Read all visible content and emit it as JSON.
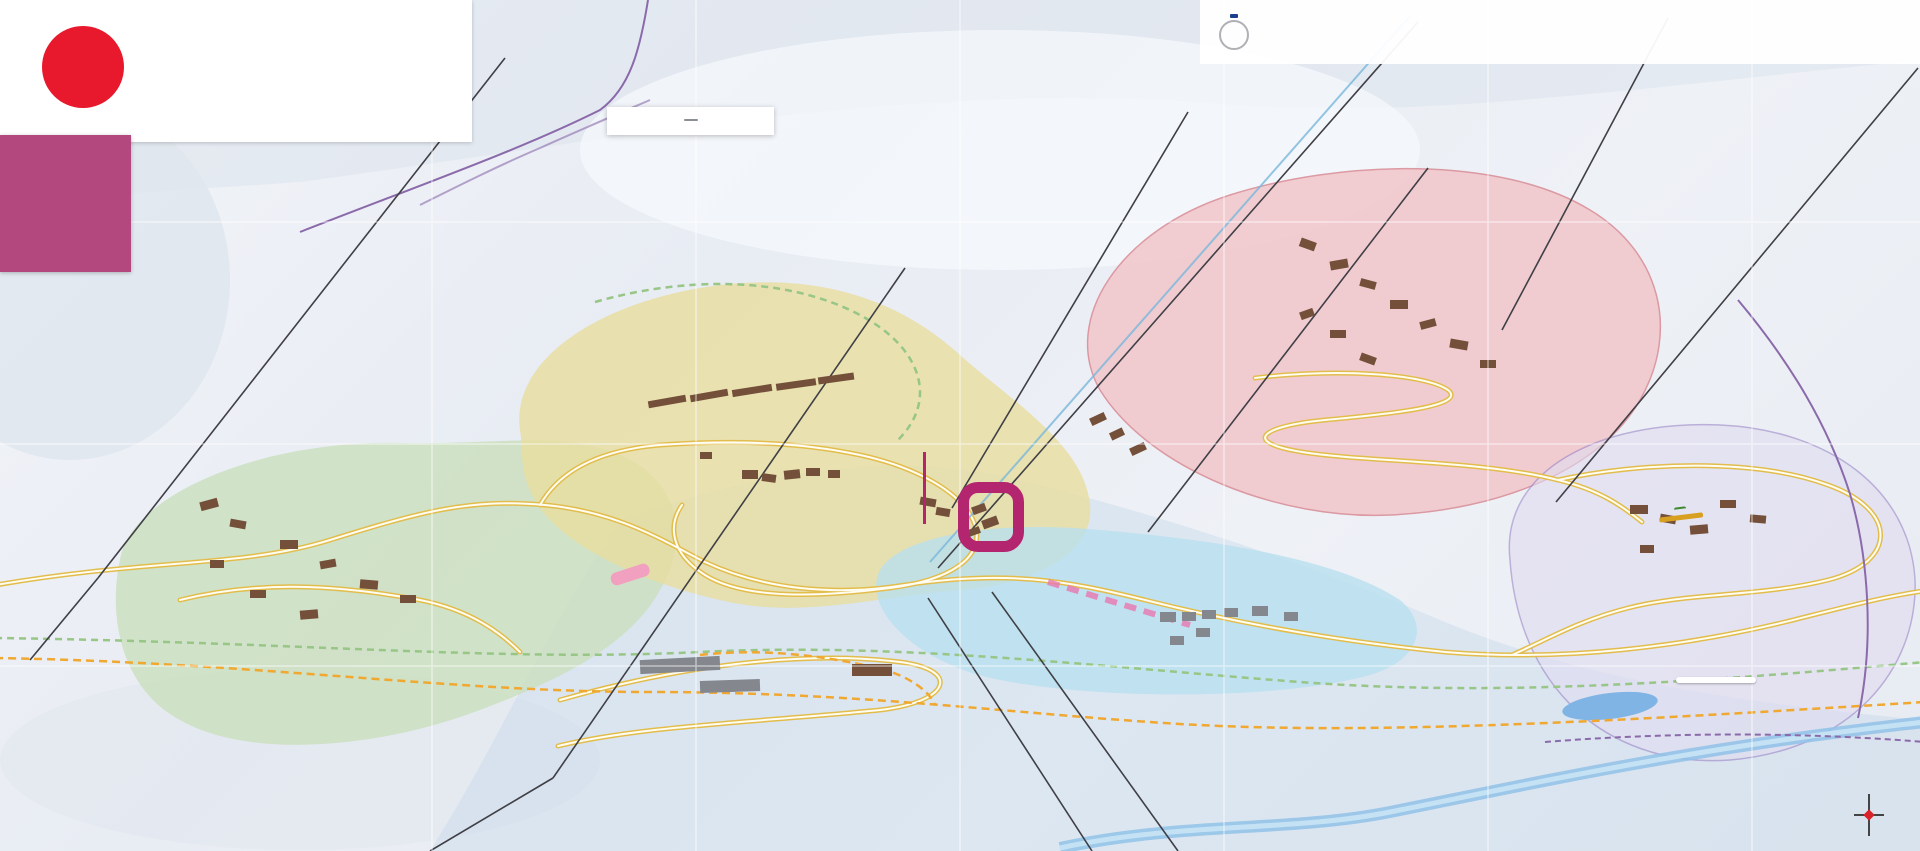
{
  "brand": {
    "logo_letter": "M",
    "name_red": "friendly",
    "name_blue": "Menuires",
    "tagline": "LES 3 VALLÉES"
  },
  "alpes": {
    "flake": "✻",
    "name": "ALPES",
    "subtitle": "IMMOBILIER & SERVICES"
  },
  "tourism": {
    "badge": "OUR QUALITY\nCOMMITMENT",
    "logo_letter": "Q",
    "logo_caption": "QUALITÉ\nTOURISME",
    "text": "L'Office de Tourisme des Menuires Saint-Martin-de-Belleville est engagé dans une démarche qualité reconnue par l'Etat et a obtenu la marque nationale QUALITE TOURISME™ pour une ou plusieurs de ses activités."
  },
  "famille": {
    "logo_blue": "Famille",
    "logo_orange": "Plus",
    "star": "★",
    "logo_sub": "VIVRE ENSEMBLE\nDE BELLES EXPÉRIENCES",
    "text_fr": "Les Menuires, station Famille Plus s'engage pour l'accueil des petits et des grands. ",
    "text_en": "A Famille Plus resort, commits itself to giving a special welcome to young and old alike."
  },
  "legend": {
    "title": "LA CROISETTE",
    "grid_ref": "C4",
    "items": [
      {
        "label": "Pharmacie",
        "sub": "Pharmacy",
        "cls": "ic-pharm",
        "icon": "pharmacy-cross"
      },
      {
        "label": "Centre médical\ndu Pelvoux",
        "sub": "Medical centre",
        "cls": "ic-med",
        "icon": "medical-cross"
      },
      {
        "label": "Sécurité des Pistes",
        "sub": "Ski patrol office",
        "cls": "ic-patrol",
        "icon": "ski-patrol-cross"
      }
    ]
  },
  "annotations": {
    "agency": "AGENCE DES ALPES",
    "dorons": "DORONS"
  },
  "directions": {
    "west": {
      "arrow": "◀",
      "text": "Vers Saint-Martin-de-Belleville\net Moûtiers"
    },
    "east": {
      "arrow": "▶",
      "text": "Vers Val Thorens"
    }
  },
  "special": {
    "la_mine_top": "LA",
    "la_mine_main": "MINE",
    "mellifera": "Mellifera",
    "mellifera_sub": "Maison de l'abeille noire\net de la ruche",
    "plan_eau": "PLAN DE L'EAU\nDES BRUYÈRES",
    "compass": {
      "n": "N",
      "s": "S",
      "e": "E",
      "w": "O"
    }
  },
  "districts": [
    {
      "t": "LA CROISETTE",
      "x": 793,
      "y": 316,
      "bg": "#efb93f",
      "s": 15
    },
    {
      "t": "GRAND REBERTY",
      "x": 1438,
      "y": 204,
      "bg": "#e23b2e",
      "s": 19
    },
    {
      "t": "LES BRUYÈRES",
      "x": 1823,
      "y": 453,
      "bg": "#9d8bc4",
      "s": 19
    },
    {
      "t": "LES FONTANETTES",
      "x": 1262,
      "y": 571,
      "bg": "#35b4dc",
      "s": 17
    },
    {
      "t": "PREYERAND",
      "x": 247,
      "y": 708,
      "bg": "#6cbf5a",
      "s": 15
    },
    {
      "t": "LE LAVASSAY",
      "x": 44,
      "y": 543,
      "bg": "#a8b2bf",
      "s": 13
    }
  ],
  "map_labels": [
    {
      "t": "La Violette",
      "x": 447,
      "y": 263,
      "r": -8,
      "cls": "road"
    },
    {
      "t": "Bettex",
      "x": 60,
      "y": 328,
      "r": -5,
      "cls": "road"
    },
    {
      "t": "Bettex",
      "x": 84,
      "y": 566,
      "r": -12,
      "cls": "road"
    },
    {
      "t": "Tortollet",
      "x": 672,
      "y": 607,
      "r": -70,
      "cls": "road"
    },
    {
      "t": "Tortollet",
      "x": 552,
      "y": 757,
      "cls": "road"
    },
    {
      "t": "Bd de la Masse",
      "x": 824,
      "y": 612,
      "r": 16,
      "cls": "road"
    },
    {
      "t": "Bd du Doron",
      "x": 895,
      "y": 768,
      "r": -3,
      "cls": "road"
    },
    {
      "t": "Bd Cumin",
      "x": 1690,
      "y": 637,
      "r": -10,
      "cls": "road"
    },
    {
      "t": "Vallons",
      "x": 1112,
      "y": 798,
      "r": 55,
      "cls": "road"
    },
    {
      "t": "Pointe de la Masse",
      "x": 1030,
      "y": 795,
      "r": 55,
      "s": 7,
      "cls": "road"
    },
    {
      "t": "Masse 1",
      "x": 966,
      "y": 780,
      "s": 7,
      "cls": "road"
    },
    {
      "t": "Boyes",
      "x": 1540,
      "y": 333,
      "r": 8,
      "cls": "road"
    },
    {
      "t": "Reberty",
      "x": 1390,
      "y": 612,
      "r": 22,
      "cls": "road"
    },
    {
      "t": "Fontanettes",
      "x": 1340,
      "y": 600,
      "r": -10,
      "cls": "road"
    },
    {
      "t": "Menuires",
      "x": 1172,
      "y": 224,
      "r": 52,
      "cls": "road"
    },
    {
      "t": "Menuires",
      "x": 1080,
      "y": 333,
      "r": 52,
      "cls": "road"
    },
    {
      "t": "Téléski du Stade",
      "x": 1038,
      "y": 283,
      "r": 52,
      "cls": "road"
    },
    {
      "t": "Montagnette",
      "x": 1232,
      "y": 372,
      "r": 45,
      "cls": "road"
    },
    {
      "t": "Sunny Express",
      "x": 1562,
      "y": 200,
      "r": -62,
      "cls": "road"
    },
    {
      "t": "Bruyères",
      "x": 1732,
      "y": 352,
      "r": 50,
      "cls": "road"
    },
    {
      "t": "BRELIN",
      "x": 790,
      "y": 413,
      "r": -10,
      "cls": "outline",
      "s": 10
    },
    {
      "t": "LES ASTERS",
      "x": 1228,
      "y": 592,
      "cls": "outline",
      "s": 9
    },
    {
      "t": "LES ALPAGES\nDE REBERTY",
      "x": 1446,
      "y": 291,
      "cls": "outline",
      "s": 9
    },
    {
      "t": "Sowell Residences",
      "x": 726,
      "y": 356,
      "s": 7
    },
    {
      "t": "Pierre Blanche",
      "x": 728,
      "y": 365,
      "s": 7
    },
    {
      "t": "Crêt Voland",
      "x": 726,
      "y": 374,
      "s": 7
    },
    {
      "t": "Côte Brune",
      "x": 776,
      "y": 366,
      "s": 7
    },
    {
      "t": "Le Danchet",
      "x": 801,
      "y": 354,
      "s": 7
    },
    {
      "t": "Pra Coutin",
      "x": 837,
      "y": 368,
      "s": 7
    },
    {
      "t": "Nant Benoit",
      "x": 783,
      "y": 376,
      "s": 7
    },
    {
      "t": "La Challe",
      "x": 819,
      "y": 380,
      "s": 7
    },
    {
      "t": "Les 3 Marches",
      "x": 705,
      "y": 381,
      "s": 7
    },
    {
      "t": "Tougnette",
      "x": 703,
      "y": 390,
      "s": 7
    },
    {
      "t": "Les Combes",
      "x": 673,
      "y": 400,
      "s": 7
    },
    {
      "t": "La Chesterie",
      "x": 664,
      "y": 409,
      "s": 7
    },
    {
      "t": "Les Evons",
      "x": 738,
      "y": 403,
      "s": 7
    },
    {
      "t": "Belambra\nClub Neige & Ciel",
      "x": 810,
      "y": 455,
      "s": 7
    },
    {
      "t": "Les Lauzes",
      "x": 665,
      "y": 457,
      "s": 7
    },
    {
      "t": "Le Pelvoux",
      "x": 820,
      "y": 462,
      "s": 7
    },
    {
      "t": "Aravis A & B",
      "x": 858,
      "y": 452,
      "s": 7
    },
    {
      "t": "L'Adret",
      "x": 748,
      "y": 490,
      "s": 7
    },
    {
      "t": "Mairie",
      "x": 771,
      "y": 493,
      "s": 7
    },
    {
      "t": "Chavière",
      "x": 800,
      "y": 491,
      "s": 7
    },
    {
      "t": "Odalys\nVacances",
      "x": 941,
      "y": 520,
      "s": 7
    },
    {
      "t": "Chanteneige\nCroisette",
      "x": 956,
      "y": 580,
      "s": 7
    },
    {
      "t": "Dorons",
      "x": 1018,
      "y": 507,
      "s": 7
    },
    {
      "t": "L'Alpeen",
      "x": 876,
      "y": 596,
      "s": 7
    },
    {
      "t": "Le Jettay",
      "x": 901,
      "y": 609,
      "s": 7
    },
    {
      "t": "Chalet Le Granitic",
      "x": 586,
      "y": 589,
      "s": 7
    },
    {
      "t": "Chalets Emma,\nMarie, Sophie\n& Alice",
      "x": 590,
      "y": 698,
      "s": 7
    },
    {
      "t": "Salle hors-sac",
      "x": 928,
      "y": 727,
      "s": 7
    },
    {
      "t": "Hôtel\nHigalik",
      "x": 157,
      "y": 484,
      "s": 7
    },
    {
      "t": "Chalet Lodge\nPure Valley",
      "x": 197,
      "y": 483,
      "s": 7
    },
    {
      "t": "Le Cœur\ndes Loges",
      "x": 256,
      "y": 466,
      "s": 7
    },
    {
      "t": "Le Chalet\nGeffriand",
      "x": 242,
      "y": 521,
      "s": 7
    },
    {
      "t": "Belambra\nLe Hameau\ndes Airelles",
      "x": 168,
      "y": 592,
      "s": 7
    },
    {
      "t": "Cristaux\n1 & 2",
      "x": 221,
      "y": 595,
      "s": 7
    },
    {
      "t": "Chalet\nHélène",
      "x": 276,
      "y": 589,
      "s": 7
    },
    {
      "t": "Le Bachal",
      "x": 310,
      "y": 557,
      "s": 7
    },
    {
      "t": "Les Clarines",
      "x": 404,
      "y": 588,
      "s": 7
    },
    {
      "t": "Le Sarvan",
      "x": 390,
      "y": 610,
      "s": 7
    },
    {
      "t": "Les Balcons",
      "x": 312,
      "y": 637,
      "s": 7
    },
    {
      "t": "Les Chalets\nde la Sapinière",
      "x": 1176,
      "y": 400,
      "s": 7
    },
    {
      "t": "Le Hameau\nde la Sapinière",
      "x": 1090,
      "y": 440,
      "s": 7
    },
    {
      "t": "Les Montagnettes",
      "x": 1096,
      "y": 456,
      "s": 7
    },
    {
      "t": "Les Chalets\ndu Soleil",
      "x": 1362,
      "y": 239,
      "s": 7
    },
    {
      "t": "Kaya\nChalet Hôtel",
      "x": 1387,
      "y": 266,
      "s": 7
    },
    {
      "t": "Julietta",
      "x": 1418,
      "y": 264,
      "s": 7
    },
    {
      "t": "Village Club\ndu Soleil",
      "x": 1315,
      "y": 272,
      "s": 7
    },
    {
      "t": "Edelweiss D",
      "x": 1410,
      "y": 301,
      "s": 7
    },
    {
      "t": "L'Ancolie",
      "x": 1455,
      "y": 306,
      "s": 7
    },
    {
      "t": "Chalet Natalia",
      "x": 1353,
      "y": 311,
      "s": 7
    },
    {
      "t": "Bleuets E",
      "x": 1397,
      "y": 321,
      "s": 7
    },
    {
      "t": "Danaïdes\nA & B",
      "x": 1443,
      "y": 330,
      "s": 7
    },
    {
      "t": "Reberty Village",
      "x": 1482,
      "y": 335,
      "s": 7
    },
    {
      "t": "Hillary Hôtel",
      "x": 1293,
      "y": 341,
      "s": 7
    },
    {
      "t": "Chalet 2000",
      "x": 1354,
      "y": 340,
      "s": 7
    },
    {
      "t": "Nécou",
      "x": 1305,
      "y": 363,
      "s": 7
    },
    {
      "t": "Chalet Lili",
      "x": 1364,
      "y": 368,
      "s": 7
    },
    {
      "t": "Tetras Lyre",
      "x": 1575,
      "y": 371,
      "s": 7
    },
    {
      "t": "Chalet de Necou",
      "x": 1282,
      "y": 388,
      "s": 7
    },
    {
      "t": "Hôtel Ours Blanc",
      "x": 1316,
      "y": 400,
      "s": 7
    },
    {
      "t": "Courmayeur",
      "x": 1506,
      "y": 400,
      "s": 7
    },
    {
      "t": "Armoise",
      "x": 1524,
      "y": 429,
      "s": 7
    },
    {
      "t": "Les Gîtes",
      "x": 1576,
      "y": 391,
      "s": 7
    },
    {
      "t": "Gentianes",
      "x": 1479,
      "y": 438,
      "s": 7
    },
    {
      "t": "Les Soldanelles",
      "x": 1576,
      "y": 469,
      "s": 7
    },
    {
      "t": "Les Origanes",
      "x": 1578,
      "y": 486,
      "s": 7
    },
    {
      "t": "La Biellay",
      "x": 1406,
      "y": 577,
      "s": 7
    },
    {
      "t": "Les Arcosses",
      "x": 1380,
      "y": 543,
      "s": 7
    },
    {
      "t": "Argousier",
      "x": 1120,
      "y": 609,
      "s": 7
    },
    {
      "t": "A1",
      "x": 1172,
      "y": 608,
      "s": 7
    },
    {
      "t": "C4",
      "x": 1193,
      "y": 608,
      "s": 7
    },
    {
      "t": "B2",
      "x": 1212,
      "y": 606,
      "s": 7
    },
    {
      "t": "C5",
      "x": 1233,
      "y": 605,
      "s": 7
    },
    {
      "t": "D3",
      "x": 1267,
      "y": 603,
      "s": 7
    },
    {
      "t": "B4",
      "x": 1300,
      "y": 610,
      "s": 7
    },
    {
      "t": "A2",
      "x": 1278,
      "y": 617,
      "s": 7
    },
    {
      "t": "C3",
      "x": 1208,
      "y": 623,
      "s": 7
    },
    {
      "t": "B1",
      "x": 1162,
      "y": 632,
      "s": 7
    },
    {
      "t": "C1",
      "x": 1183,
      "y": 639,
      "s": 7
    },
    {
      "t": "C2",
      "x": 1202,
      "y": 640,
      "s": 7
    },
    {
      "t": "Les Campanules",
      "x": 1237,
      "y": 657,
      "s": 7
    },
    {
      "t": "Chalet Aigle",
      "x": 1440,
      "y": 610,
      "s": 7
    },
    {
      "t": "Chalet\nPerce-Neige",
      "x": 1452,
      "y": 624,
      "s": 7
    },
    {
      "t": "Chalet Purple",
      "x": 1468,
      "y": 640,
      "s": 7
    },
    {
      "t": "Chalet de la\nDame Blanche",
      "x": 1445,
      "y": 660,
      "s": 7
    },
    {
      "t": "Chalet Corbeau",
      "x": 1437,
      "y": 686,
      "s": 7
    },
    {
      "t": "Les Chalets\nde l'Adonis",
      "x": 1760,
      "y": 500,
      "s": 7
    },
    {
      "t": "Les Valmonts",
      "x": 1763,
      "y": 548,
      "s": 7
    },
    {
      "t": "L'Orée\ndes Pistes",
      "x": 1622,
      "y": 542,
      "s": 7
    },
    {
      "t": "Chalet\nBruyères",
      "x": 1665,
      "y": 550,
      "s": 7
    },
    {
      "t": "Chalet\nVithos",
      "x": 1655,
      "y": 576,
      "s": 7
    },
    {
      "t": "Chalet Cocon\ndes Neiges",
      "x": 1692,
      "y": 570,
      "s": 7
    }
  ],
  "markers": [
    {
      "t": "M",
      "x": 510,
      "y": 16,
      "bg": "#b3256e"
    },
    {
      "t": "L",
      "x": 668,
      "y": 14,
      "bg": "#b3256e"
    },
    {
      "t": "4",
      "x": 782,
      "y": 14,
      "bg": "#3aa648"
    },
    {
      "t": "K",
      "x": 782,
      "y": 36,
      "bg": "#b3256e"
    },
    {
      "t": "L",
      "x": 497,
      "y": 133,
      "bg": "#7b5ea7"
    },
    {
      "t": "H",
      "x": 560,
      "y": 347,
      "bg": "#2a7fc8"
    },
    {
      "t": "L",
      "x": 584,
      "y": 347,
      "bg": "#7b5ea7"
    },
    {
      "t": "M",
      "x": 625,
      "y": 352,
      "bg": "#b3256e"
    },
    {
      "t": "F",
      "x": 68,
      "y": 627,
      "bg": "#b3256e",
      "cls": "pill"
    },
    {
      "t": "E",
      "x": 1751,
      "y": 328,
      "bg": "#7b5ea7"
    },
    {
      "t": "C",
      "x": 1853,
      "y": 494,
      "bg": "#7b5ea7"
    },
    {
      "t": "J",
      "x": 1876,
      "y": 100,
      "bg": "#7b5ea7"
    },
    {
      "t": "A",
      "x": 723,
      "y": 657,
      "bg": "#f0c030",
      "fg": "#333"
    },
    {
      "t": "F",
      "x": 913,
      "y": 575,
      "bg": "#f0c030",
      "fg": "#333"
    },
    {
      "t": "G",
      "x": 855,
      "y": 578,
      "bg": "#f0c030",
      "fg": "#333"
    },
    {
      "t": "I",
      "x": 1290,
      "y": 258,
      "bg": "#f0c030",
      "fg": "#333"
    },
    {
      "t": "J",
      "x": 1500,
      "y": 352,
      "bg": "#f0c030",
      "fg": "#333"
    },
    {
      "t": "D",
      "x": 977,
      "y": 528,
      "bg": "#f0c030",
      "fg": "#333"
    },
    {
      "t": "O",
      "x": 993,
      "y": 530,
      "bg": "#f0c030",
      "fg": "#333"
    },
    {
      "t": "K",
      "x": 1004,
      "y": 519,
      "bg": "#f0c030",
      "fg": "#333"
    },
    {
      "t": "1",
      "x": 1490,
      "y": 296,
      "bg": "#d8232a"
    },
    {
      "t": "2",
      "x": 1468,
      "y": 319,
      "bg": "#2a9fd8"
    },
    {
      "t": "1",
      "x": 170,
      "y": 498,
      "bg": "#111"
    },
    {
      "t": "8",
      "x": 186,
      "y": 498,
      "bg": "#111"
    },
    {
      "t": "7",
      "x": 1632,
      "y": 582,
      "bg": "#111"
    },
    {
      "t": "i",
      "x": 453,
      "y": 551,
      "bg": "#2a7fc8"
    },
    {
      "t": "3b",
      "x": 878,
      "y": 670,
      "bg": "#f09020",
      "cls": "pill"
    },
    {
      "t": "3",
      "x": 820,
      "y": 710,
      "bg": "#f09020",
      "cls": "pill"
    },
    {
      "t": "26",
      "x": 1660,
      "y": 672,
      "bg": "#8a4a9a",
      "cls": "pill"
    },
    {
      "t": "25",
      "x": 1640,
      "y": 687,
      "bg": "#3aa648",
      "cls": "pill"
    },
    {
      "t": "27",
      "x": 1778,
      "y": 737,
      "bg": "#8a4a9a",
      "cls": "pill"
    },
    {
      "t": "28",
      "x": 1897,
      "y": 697,
      "bg": "#8a4a9a",
      "cls": "pill"
    },
    {
      "t": "6",
      "x": 1803,
      "y": 699,
      "bg": "#2a9fd8",
      "cls": "pill"
    },
    {
      "t": "6",
      "x": 1910,
      "y": 687,
      "bg": "#2a9fd8",
      "cls": "pill"
    },
    {
      "t": "V",
      "x": 194,
      "y": 562,
      "bg": "#3aa648"
    },
    {
      "t": "V",
      "x": 822,
      "y": 487,
      "bg": "#3aa648"
    },
    {
      "t": "V",
      "x": 1367,
      "y": 280,
      "bg": "#3aa648"
    },
    {
      "t": "⇕",
      "x": 752,
      "y": 455,
      "bg": "#f078b8"
    },
    {
      "t": "⇕",
      "x": 950,
      "y": 602,
      "bg": "#f078b8"
    },
    {
      "t": "⇕",
      "x": 1706,
      "y": 524,
      "bg": "#f078b8"
    },
    {
      "t": "P",
      "x": 900,
      "y": 578,
      "bg": "#2a5aa8",
      "cls": "sq"
    },
    {
      "t": "P",
      "x": 1645,
      "y": 600,
      "bg": "#2a5aa8",
      "cls": "sq"
    },
    {
      "t": "P",
      "x": 1010,
      "y": 602,
      "bg": "#2a5aa8",
      "cls": "sq"
    },
    {
      "t": "✚",
      "x": 938,
      "y": 552,
      "bg": "#d8232a",
      "fg": "#ffd400",
      "cls": "sq"
    },
    {
      "t": "✚",
      "x": 824,
      "y": 492,
      "bg": "#3aa648",
      "cls": "sq"
    },
    {
      "t": "✚",
      "x": 841,
      "y": 491,
      "bg": "#ffffff",
      "fg": "#2a5aa8",
      "cls": "sq"
    },
    {
      "t": "SKI\nPASS",
      "x": 953,
      "y": 540,
      "bg": "#2a5aa8",
      "cls": "skipass"
    },
    {
      "t": "SKI\nPASS",
      "x": 1615,
      "y": 560,
      "bg": "#2a5aa8",
      "cls": "skipass"
    },
    {
      "t": "SKI\nPASS",
      "x": 1516,
      "y": 455,
      "bg": "#2a5aa8",
      "cls": "skipass"
    },
    {
      "t": "WiFi",
      "x": 1163,
      "y": 705,
      "bg": "#222222",
      "cls": "pill",
      "s": 6
    }
  ],
  "colors": {
    "accent_magenta": "#b3256e",
    "croisette_yellow": "#efb93f",
    "reberty_red": "#e23b2e",
    "bruyeres_purple": "#9d8bc4",
    "fontanettes_cyan": "#35b4dc",
    "preyerand_green": "#6cbf5a",
    "brand_red": "#e8192c",
    "brand_blue": "#233e7e",
    "alpes_pink": "#b3487e"
  }
}
